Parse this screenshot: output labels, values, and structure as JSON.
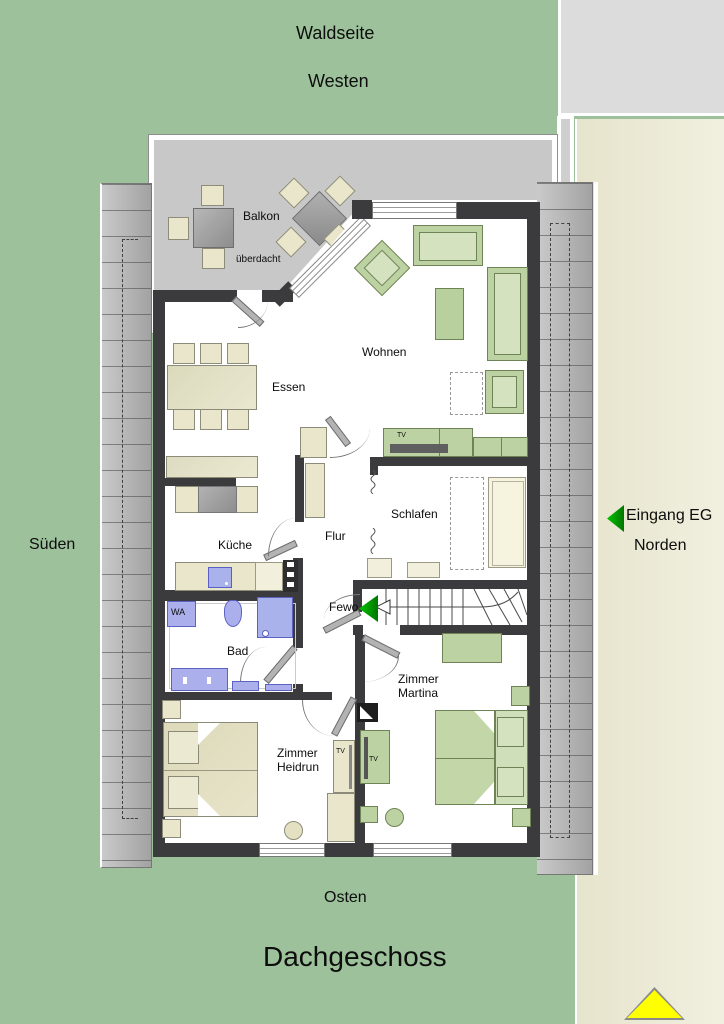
{
  "title": "Dachgeschoss",
  "compass": {
    "forest_side": "Waldseite",
    "west": "Westen",
    "south": "Süden",
    "north": "Norden",
    "east": "Osten"
  },
  "entrance": {
    "label": "Eingang EG",
    "apartment_door": "Fewo"
  },
  "rooms": {
    "balcony": "Balkon",
    "balcony_note": "überdacht",
    "living": "Wohnen",
    "dining": "Essen",
    "kitchen": "Küche",
    "hall": "Flur",
    "bedroom": "Schlafen",
    "bath": "Bad",
    "washer": "WA",
    "tv": "TV",
    "room_martina_line1": "Zimmer",
    "room_martina_line2": "Martina",
    "room_heidrun_line1": "Zimmer",
    "room_heidrun_line2": "Heidrun"
  },
  "colors": {
    "site_green": "#9dc29b",
    "site_beige": "#e9e7d1",
    "balcony_gray": "#c8c8c8",
    "wall_dark": "#3b3b3d",
    "furniture_green": "#bdd2a3",
    "furniture_cream": "#e9e6cb",
    "sanitary_purple": "#abb0ed",
    "arrow_green": "#00a000",
    "marker_yellow": "#ffff00"
  }
}
